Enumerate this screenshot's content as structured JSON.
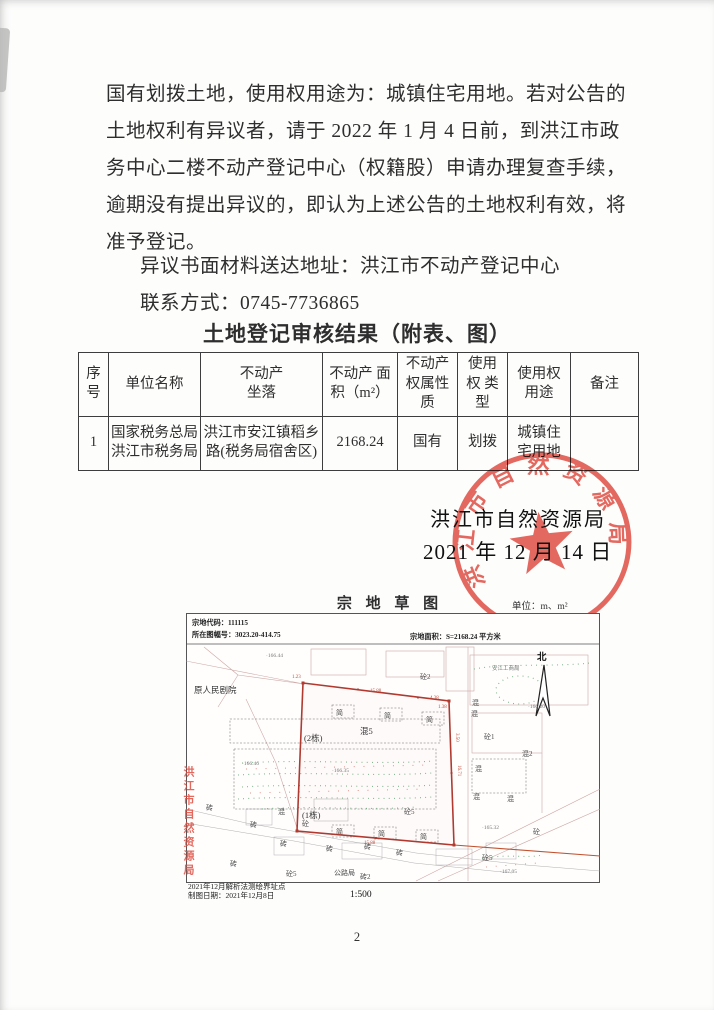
{
  "page": {
    "number": "2"
  },
  "notice": {
    "lines": [
      "国有划拨土地，使用权用途为：城镇住宅用地。若对公告的",
      "土地权利有异议者，请于 2022 年 1 月 4 日前，到洪江市政",
      "务中心二楼不动产登记中心（权籍股）申请办理复查手续，",
      "逾期没有提出异议的，即认为上述公告的土地权利有效，将",
      "准予登记。"
    ],
    "address_line": "异议书面材料送达地址：洪江市不动产登记中心",
    "contact_line": "联系方式：0745-7736865"
  },
  "table": {
    "title": "土地登记审核结果（附表、图）",
    "headers": [
      "序\n号",
      "单位名称",
      "不动产\n坐落",
      "不动产 面\n积（m²）",
      "不动产\n权属性\n质",
      "使用\n权 类\n型",
      "使用权\n用途",
      "备注"
    ],
    "rows": [
      [
        "1",
        "国家税务总局\n洪江市税务局",
        "洪江市安江镇稻乡\n路(税务局宿舍区)",
        "2168.24",
        "国有",
        "划拨",
        "城镇住\n宅用地",
        ""
      ]
    ]
  },
  "signature": {
    "authority": "洪江市自然资源局",
    "date": "2021 年 12 月 14 日",
    "seal_text": "洪江市自然资源局",
    "seal_color": "#e2554b"
  },
  "map": {
    "title": "宗 地 草 图",
    "unit_label": "单位：m、m²",
    "parcel_code": "宗地代码：111115",
    "sheet_no": "所在图幅号：3023.20-414.75",
    "parcel_area": "宗地面积：S=2168.24 平方米",
    "scale": "1:500",
    "survey_note": "2021年12月解析法测绘界址点",
    "drawing_date": "制图日期：2021年12月8日",
    "side_stamp": "洪江市自然资源局",
    "annotations": [
      {
        "t": "原人民剧院",
        "x": 8,
        "y": 80,
        "c": "b"
      },
      {
        "t": "·166.44",
        "x": 80,
        "y": 44,
        "c": "e"
      },
      {
        "t": "砼2",
        "x": 234,
        "y": 66,
        "c": "m"
      },
      {
        "t": "安江工商局",
        "x": 306,
        "y": 57,
        "c": "e"
      },
      {
        "t": "·166.20",
        "x": 342,
        "y": 95,
        "c": "e"
      },
      {
        "t": "北",
        "x": 351,
        "y": 47,
        "c": "n"
      },
      {
        "t": "混",
        "x": 286,
        "y": 92,
        "c": "m"
      },
      {
        "t": "混",
        "x": 285,
        "y": 103,
        "c": "m"
      },
      {
        "t": "砼1",
        "x": 298,
        "y": 126,
        "c": "m"
      },
      {
        "t": "混2",
        "x": 336,
        "y": 143,
        "c": "m"
      },
      {
        "t": "混",
        "x": 289,
        "y": 158,
        "c": "m"
      },
      {
        "t": "混",
        "x": 287,
        "y": 186,
        "c": "m"
      },
      {
        "t": "混",
        "x": 321,
        "y": 188,
        "c": "m"
      },
      {
        "t": "砼",
        "x": 347,
        "y": 221,
        "c": "m"
      },
      {
        "t": "砼5",
        "x": 296,
        "y": 247,
        "c": "m"
      },
      {
        "t": "·167.05",
        "x": 314,
        "y": 260,
        "c": "e"
      },
      {
        "t": "·165.32",
        "x": 296,
        "y": 216,
        "c": "e"
      },
      {
        "t": "简",
        "x": 150,
        "y": 102,
        "c": "m"
      },
      {
        "t": "简",
        "x": 198,
        "y": 105,
        "c": "m"
      },
      {
        "t": "简",
        "x": 240,
        "y": 109,
        "c": "m"
      },
      {
        "t": "混5",
        "x": 174,
        "y": 121,
        "c": "b"
      },
      {
        "t": "(2栋)",
        "x": 118,
        "y": 128,
        "c": "b"
      },
      {
        "t": "·166.35",
        "x": 146,
        "y": 159,
        "c": "e"
      },
      {
        "t": "·166.46",
        "x": 56,
        "y": 152,
        "c": "e"
      },
      {
        "t": "(1栋)",
        "x": 116,
        "y": 205,
        "c": "b"
      },
      {
        "t": "混",
        "x": 92,
        "y": 201,
        "c": "m"
      },
      {
        "t": "砼",
        "x": 116,
        "y": 213,
        "c": "m"
      },
      {
        "t": "砼5",
        "x": 218,
        "y": 201,
        "c": "m"
      },
      {
        "t": "简",
        "x": 150,
        "y": 221,
        "c": "m"
      },
      {
        "t": "简",
        "x": 192,
        "y": 223,
        "c": "m"
      },
      {
        "t": "简",
        "x": 234,
        "y": 226,
        "c": "m"
      },
      {
        "t": "砖",
        "x": 20,
        "y": 197,
        "c": "m"
      },
      {
        "t": "砖",
        "x": 64,
        "y": 214,
        "c": "m"
      },
      {
        "t": "砖",
        "x": 94,
        "y": 233,
        "c": "m"
      },
      {
        "t": "砖",
        "x": 140,
        "y": 238,
        "c": "m"
      },
      {
        "t": "砖",
        "x": 178,
        "y": 236,
        "c": "m"
      },
      {
        "t": "砖",
        "x": 44,
        "y": 253,
        "c": "m"
      },
      {
        "t": "砖",
        "x": 210,
        "y": 242,
        "c": "m"
      },
      {
        "t": "公路局",
        "x": 148,
        "y": 262,
        "c": "m"
      },
      {
        "t": "砖2",
        "x": 174,
        "y": 266,
        "c": "m"
      },
      {
        "t": "砼5",
        "x": 100,
        "y": 263,
        "c": "m"
      },
      {
        "t": "1.23",
        "x": 106,
        "y": 65,
        "c": "d"
      },
      {
        "t": "15.88",
        "x": 184,
        "y": 79,
        "c": "d"
      },
      {
        "t": "4.38",
        "x": 244,
        "y": 86,
        "c": "d"
      },
      {
        "t": "1.38",
        "x": 252,
        "y": 95,
        "c": "d"
      },
      {
        "t": "3.50",
        "x": 270,
        "y": 120,
        "c": "d",
        "r": 90
      },
      {
        "t": "16.71",
        "x": 272,
        "y": 152,
        "c": "d",
        "r": 90
      },
      {
        "t": "15.88",
        "x": 178,
        "y": 231,
        "c": "d"
      }
    ]
  }
}
